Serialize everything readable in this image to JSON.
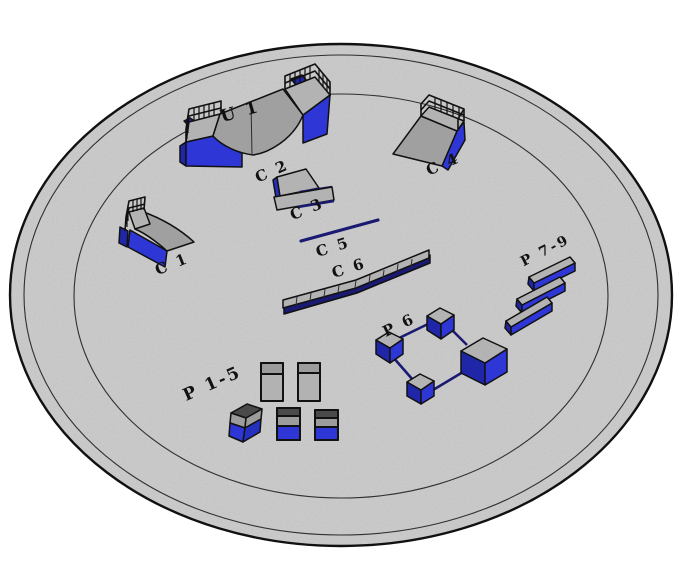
{
  "scene": {
    "kind": "skatepark-obstacle-layout-3d",
    "ground": "circular-concrete-pad"
  },
  "labels": {
    "u1": "U 1",
    "c1": "C 1",
    "c2": "C 2",
    "c3": "C 3",
    "c4": "C 4",
    "c5": "C 5",
    "c6": "C 6",
    "p6": "P 6",
    "p7_9": "P 7-9",
    "p1_5": "P 1-5"
  },
  "colors": {
    "ink": "#111111",
    "ground": "#c9c9c9",
    "ring": "#2f2f2f",
    "gray_top": "#b3b3b3",
    "gray_mid": "#a6a6a6",
    "gray_slope": "#a0a0a0",
    "gray_panel": "#b2b2b2",
    "gray_band": "#9c9c9c",
    "gray_dark": "#4a4a4a",
    "blue_bright": "#2e36d6",
    "blue_mid": "#2630c0",
    "blue_dark": "#1f27a8",
    "navy": "#1a1a72"
  }
}
